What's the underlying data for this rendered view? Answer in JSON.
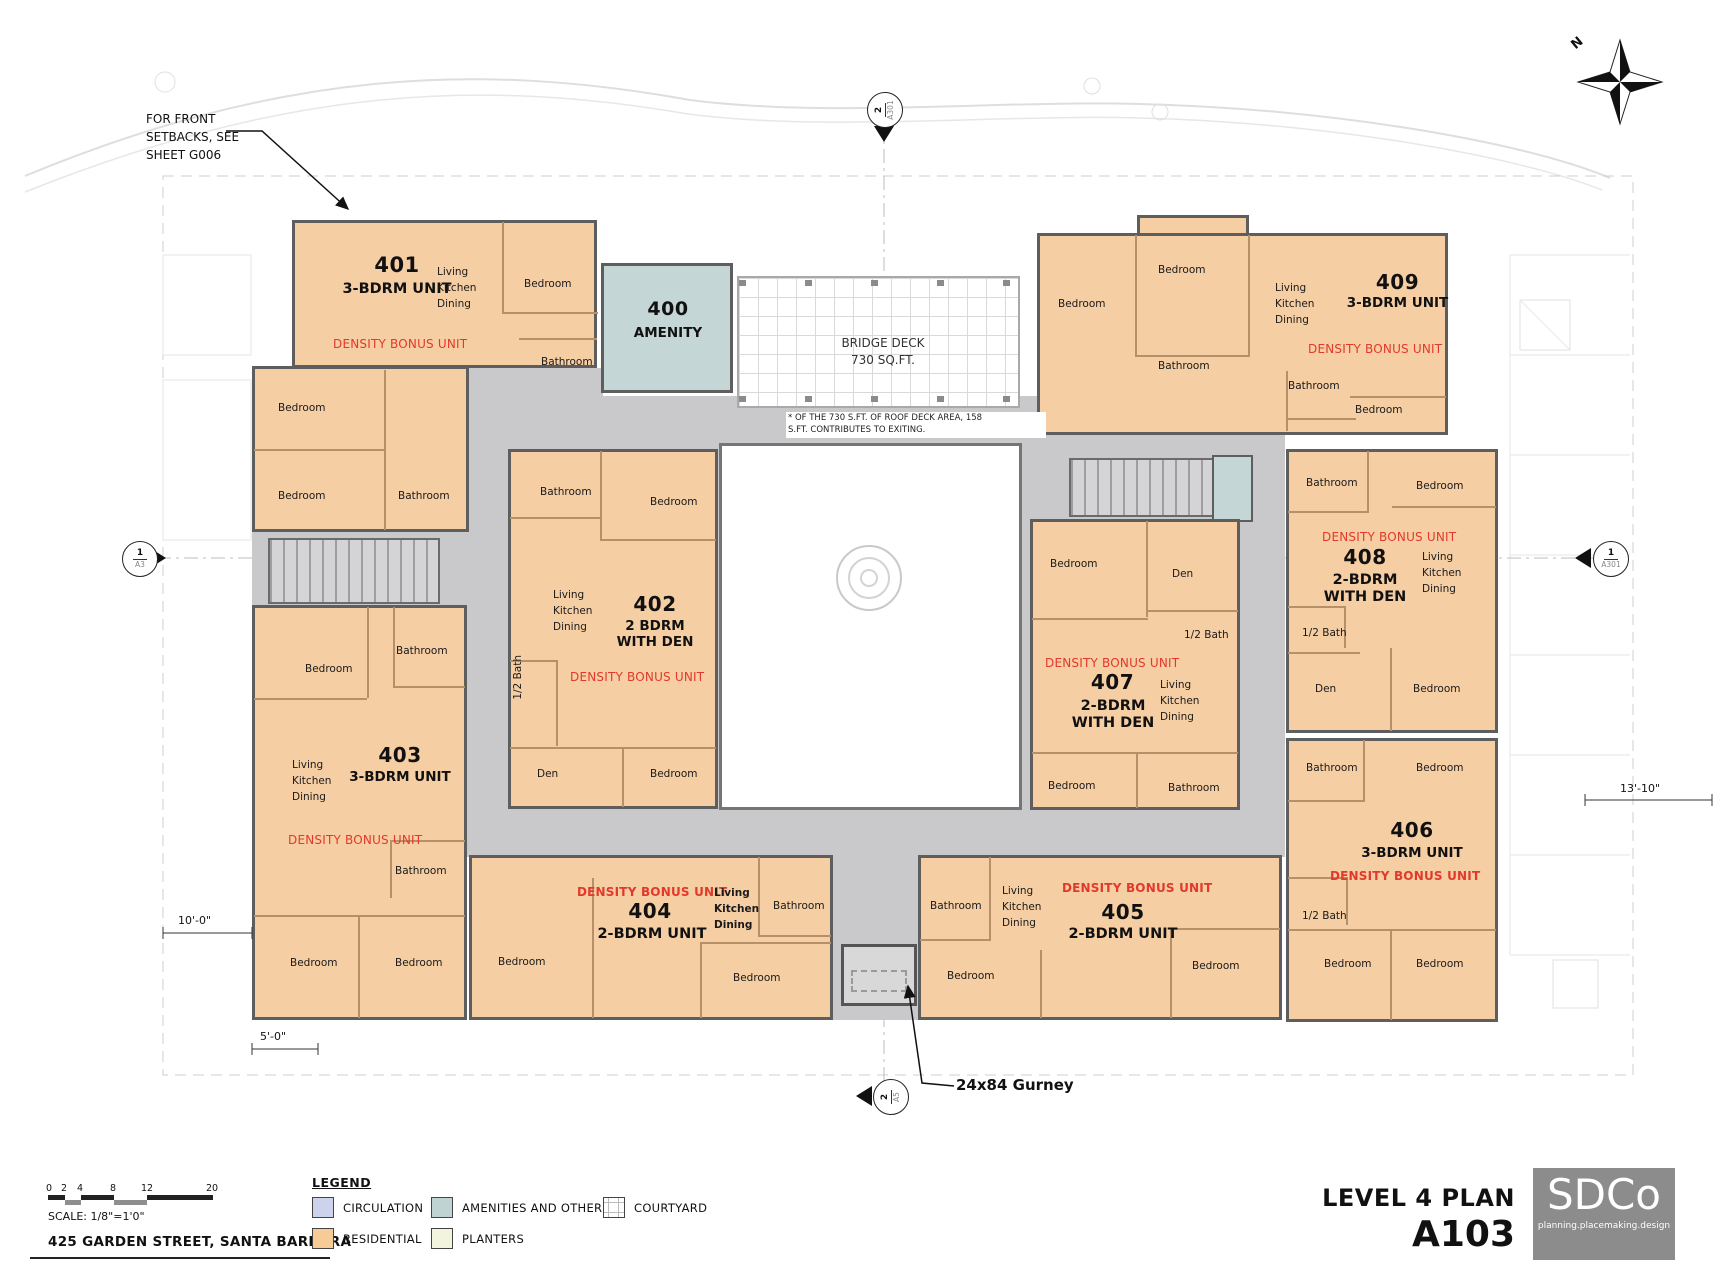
{
  "annotations": {
    "setback_note": "FOR FRONT\nSETBACKS, SEE\nSHEET G006",
    "gurney": "24x84 Gurney",
    "north": "N",
    "dim_right": "13'-10\"",
    "dim_left": "10'-0\"",
    "dim_bottom": "5'-0\""
  },
  "bridge": {
    "name": "BRIDGE DECK",
    "area": "730 SQ.FT.",
    "note": "* OF THE 730 S.FT. OF ROOF DECK AREA, 158\nS.FT. CONTRIBUTES TO EXITING."
  },
  "amenity": {
    "num": "400",
    "name": "AMENITY"
  },
  "density_label": "DENSITY BONUS UNIT",
  "room_labels": {
    "bedroom": "Bedroom",
    "bathroom": "Bathroom",
    "half_bath": "1/2 Bath",
    "den": "Den",
    "lkd": "Living\nKitchen\nDining"
  },
  "units": {
    "u401": {
      "num": "401",
      "type": "3-BDRM UNIT"
    },
    "u402": {
      "num": "402",
      "type": "2 BDRM\nWITH DEN"
    },
    "u403": {
      "num": "403",
      "type": "3-BDRM UNIT"
    },
    "u404": {
      "num": "404",
      "type": "2-BDRM UNIT"
    },
    "u405": {
      "num": "405",
      "type": "2-BDRM UNIT"
    },
    "u406": {
      "num": "406",
      "type": "3-BDRM UNIT"
    },
    "u407": {
      "num": "407",
      "type": "2-BDRM\nWITH DEN"
    },
    "u408": {
      "num": "408",
      "type": "2-BDRM\nWITH DEN"
    },
    "u409": {
      "num": "409",
      "type": "3-BDRM UNIT"
    }
  },
  "markers": {
    "left": {
      "num": "1",
      "sheet": "A3"
    },
    "right": {
      "num": "1",
      "sheet": "A301"
    },
    "top": {
      "num": "2",
      "sheet": "A301"
    },
    "bottom": {
      "num": "2",
      "sheet": "A5"
    }
  },
  "legend": {
    "title": "LEGEND",
    "items": [
      {
        "label": "CIRCULATION",
        "color": "#CDD3EC"
      },
      {
        "label": "RESIDENTIAL",
        "color": "#F6CB96"
      },
      {
        "label": "AMENITIES AND OTHER",
        "color": "#BFD3D3"
      },
      {
        "label": "PLANTERS",
        "color": "#F2F4DE"
      },
      {
        "label": "COURTYARD",
        "color": "#FFFFFF"
      }
    ]
  },
  "scalebar": {
    "ticks": [
      "0",
      "2",
      "4",
      "8",
      "12",
      "20"
    ],
    "label": "SCALE: 1/8\"=1'0\""
  },
  "address": "425 GARDEN STREET, SANTA BARBARA",
  "titleblock": {
    "title": "LEVEL 4 PLAN",
    "sheet": "A103",
    "logo": "SDCo",
    "tagline": "planning.placemaking.design"
  },
  "colors": {
    "residential": "#F6CEA3",
    "circulation_plan": "#C9C9CB",
    "amenity": "#C5D6D7",
    "wall": "#5E5E5E",
    "partition": "#B59069",
    "density_red": "#E2392B"
  }
}
